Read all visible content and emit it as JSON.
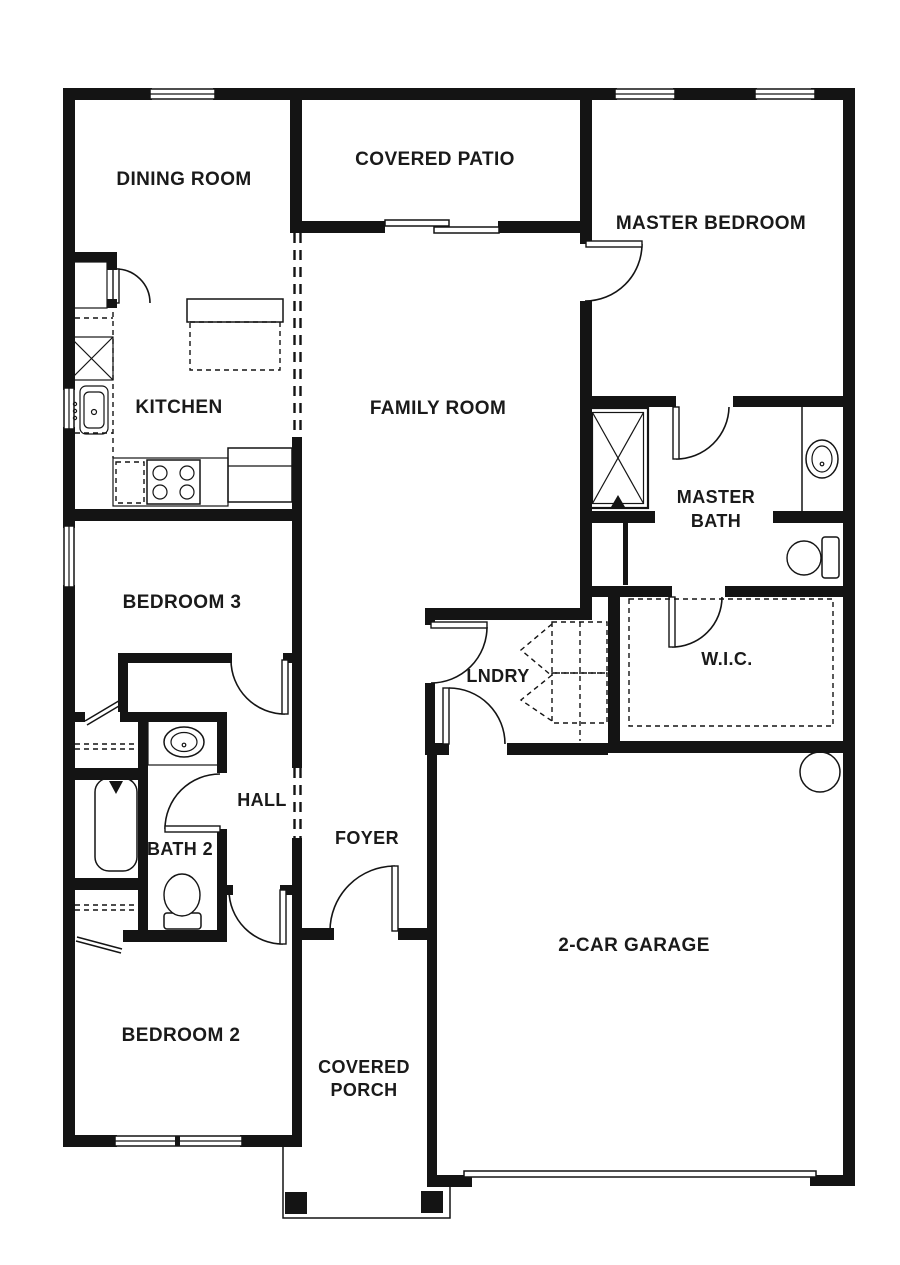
{
  "title": "Single-story house floor plan",
  "colors": {
    "wall": "#141414",
    "background": "#ffffff",
    "label": "#1a1a1a"
  },
  "rooms": {
    "dining": {
      "label": "DINING ROOM"
    },
    "patio": {
      "label": "COVERED PATIO"
    },
    "master_bedroom": {
      "label": "MASTER BEDROOM"
    },
    "kitchen": {
      "label": "KITCHEN"
    },
    "family": {
      "label": "FAMILY ROOM"
    },
    "master_bath": {
      "line1": "MASTER",
      "line2": "BATH"
    },
    "bedroom3": {
      "label": "BEDROOM 3"
    },
    "laundry": {
      "label": "LNDRY"
    },
    "wic": {
      "label": "W.I.C."
    },
    "hall": {
      "label": "HALL"
    },
    "bath2": {
      "label": "BATH 2"
    },
    "foyer": {
      "label": "FOYER"
    },
    "garage": {
      "label": "2-CAR GARAGE"
    },
    "bedroom2": {
      "label": "BEDROOM 2"
    },
    "porch": {
      "line1": "COVERED",
      "line2": "PORCH"
    }
  },
  "fixtures": [
    "kitchen-island",
    "pantry-cabinet",
    "kitchen-sink",
    "range-stove",
    "refrigerator",
    "washer",
    "dryer",
    "walk-in-closet-shelving",
    "shower",
    "master-vanity-sink",
    "master-toilet",
    "bathtub",
    "bath2-vanity-sink",
    "bath2-toilet",
    "water-heater",
    "garage-door",
    "front-door",
    "patio-sliding-door",
    "porch-posts",
    "closet-shelves",
    "windows"
  ]
}
